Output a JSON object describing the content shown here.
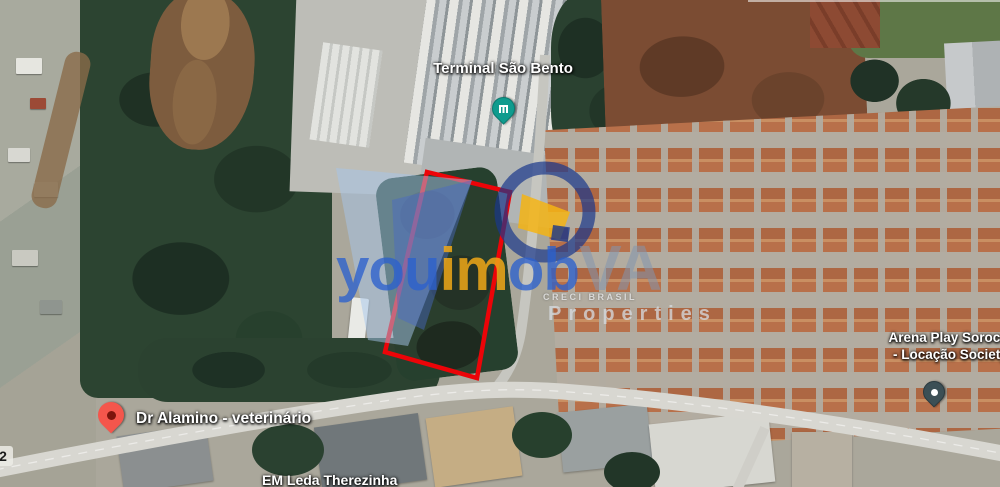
{
  "map": {
    "view": "satellite",
    "poi": {
      "terminal": {
        "label": "Terminal São Bento"
      },
      "vet": {
        "label": "Dr Alamino - veterinário"
      },
      "arena": {
        "label_line1": "Arena Play Sorocaba",
        "label_line2": "- Locação Society e"
      },
      "school": {
        "label": "EM Leda Therezinha"
      },
      "road_number": "2"
    },
    "pins": {
      "terminal": {
        "icon": "transit-terminal-pin",
        "color": "#0f9b8e"
      },
      "vet": {
        "icon": "red-place-pin",
        "color": "#f4564c"
      },
      "arena": {
        "icon": "sports-venue-pin",
        "color": "#3c4f55"
      }
    },
    "parcel": {
      "outline_color": "#ec0408",
      "points": "427,172 510,192 477,378 385,352"
    }
  },
  "watermark": {
    "brand_prefix": "you",
    "brand_mid": "im",
    "brand_end": "ob",
    "brand_suffix": "VA",
    "tagline_small": "CRECI BRASIL",
    "tagline_large": "Properties",
    "colors": {
      "blue": "#2b60cd",
      "yellow": "#f0a818",
      "gray": "#8296aa"
    }
  }
}
